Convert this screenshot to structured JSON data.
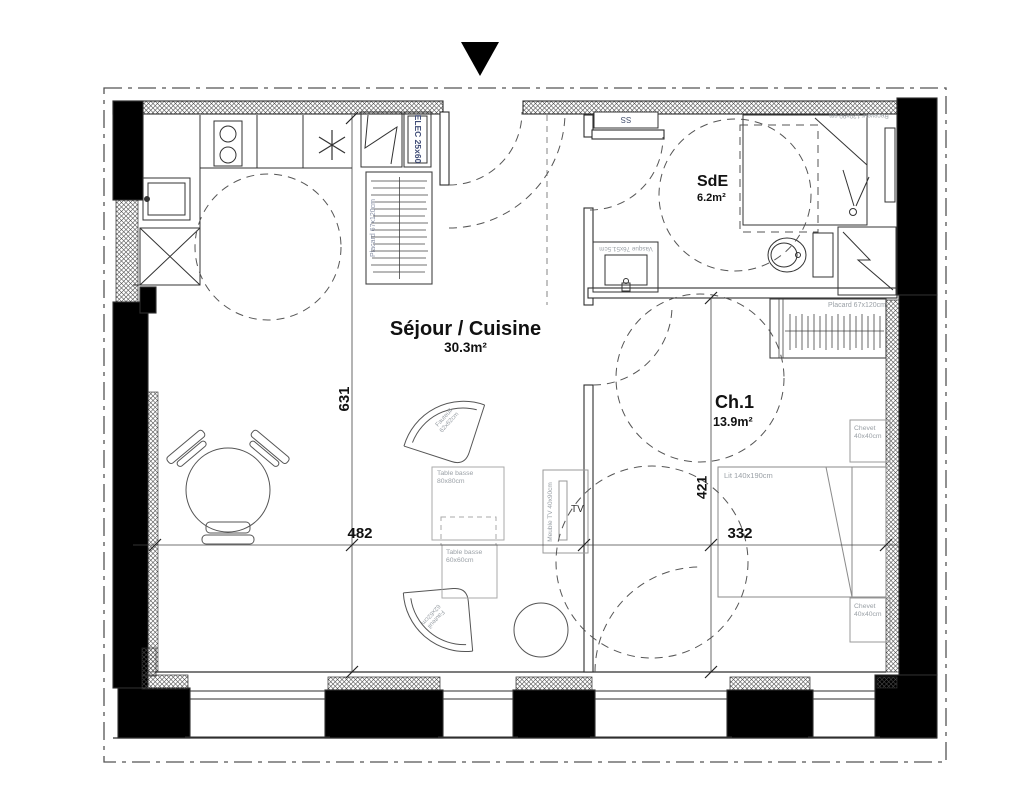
{
  "labels": {
    "rooms": {
      "sejour": {
        "name": "Séjour / Cuisine",
        "area": "30.3m²"
      },
      "sde": {
        "name": "SdE",
        "area": "6.2m²"
      },
      "ch1": {
        "name": "Ch.1",
        "area": "13.9m²"
      }
    },
    "dimensions": {
      "d631": "631",
      "d482": "482",
      "d421": "421",
      "d332": "332"
    },
    "furniture": {
      "elec": "ELEC 25x60",
      "placard_kitchen": "Placard 67x120cm",
      "placard_ch1": "Placard 67x120cm",
      "ss": "SS",
      "vasque": "Vasque 76x51.5cm",
      "receveur": "Receveur 120x90 cm",
      "lit": "Lit 140x190cm",
      "chevet_top": "Chevet\n40x40cm",
      "chevet_bottom": "Chevet\n40x40cm",
      "fauteuil_top": "Fauteuil\n62x62cm",
      "fauteuil_bottom": "Fauteuil\n62x62cm",
      "table_basse_80": "Table basse\n80x80cm",
      "table_basse_60": "Table basse\n60x60cm",
      "meuble_tv": "Meuble TV 40x90cm",
      "tv": "TV"
    },
    "colors": {
      "wall_line": "#2e2e2e",
      "label_gray": "#9aa0a6",
      "label_navy": "#3d4a75",
      "room_text": "#111111"
    }
  }
}
